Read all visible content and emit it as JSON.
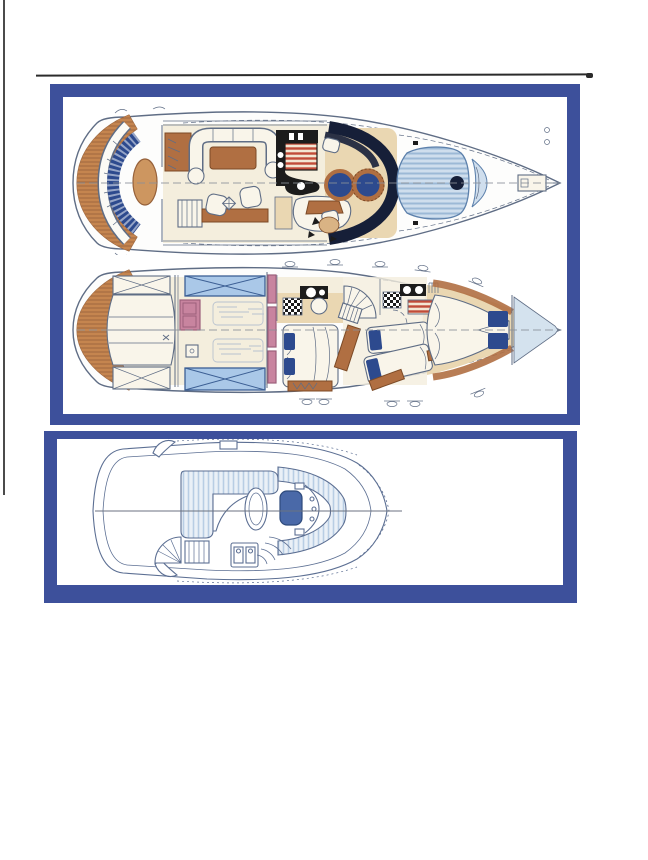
{
  "document": {
    "kind": "scanned-yacht-deck-plans",
    "visible_text": "",
    "panels": {
      "upper": {
        "name": "upper-plans-panel",
        "plans": [
          {
            "id": "main-deck",
            "label": "main deck plan"
          },
          {
            "id": "lower-deck",
            "label": "lower deck accommodation plan"
          }
        ]
      },
      "lower": {
        "name": "flybridge-panel",
        "plans": [
          {
            "id": "flybridge",
            "label": "flybridge plan"
          }
        ]
      }
    },
    "scan_artifacts": {
      "top_rule": true,
      "left_edge_rule": true
    }
  },
  "palette": {
    "paper": "#ffffff",
    "border_blue": "#3d509b",
    "scan_line": "#2b2b2b",
    "ink": "#1c1c1c",
    "draw": "#5f6d85",
    "teak": "#c5854f",
    "teak_dark": "#96613a",
    "tan": "#ead7b2",
    "cream": "#f4eedd",
    "upholstery": "#f9f5ea",
    "brown": "#b06f42",
    "brown_dark": "#7c4a26",
    "navy": "#2d4a8e",
    "dark_navy": "#161f38",
    "sunpad": "#cfdeed",
    "sunpad_stripe": "#9cb9d6",
    "red": "#c14b38",
    "red_bg": "#f3e6d2",
    "mauve": "#c8849f",
    "mauve_dark": "#9c5f7b",
    "engine_blue": "#aac8e8",
    "engine_line": "#3c5f94",
    "fly_line": "#5c6f93",
    "fly_seat": "#4a69a8",
    "fly_stripe": "#b8cde4",
    "bow_locker_blue": "#d4e2ee"
  }
}
